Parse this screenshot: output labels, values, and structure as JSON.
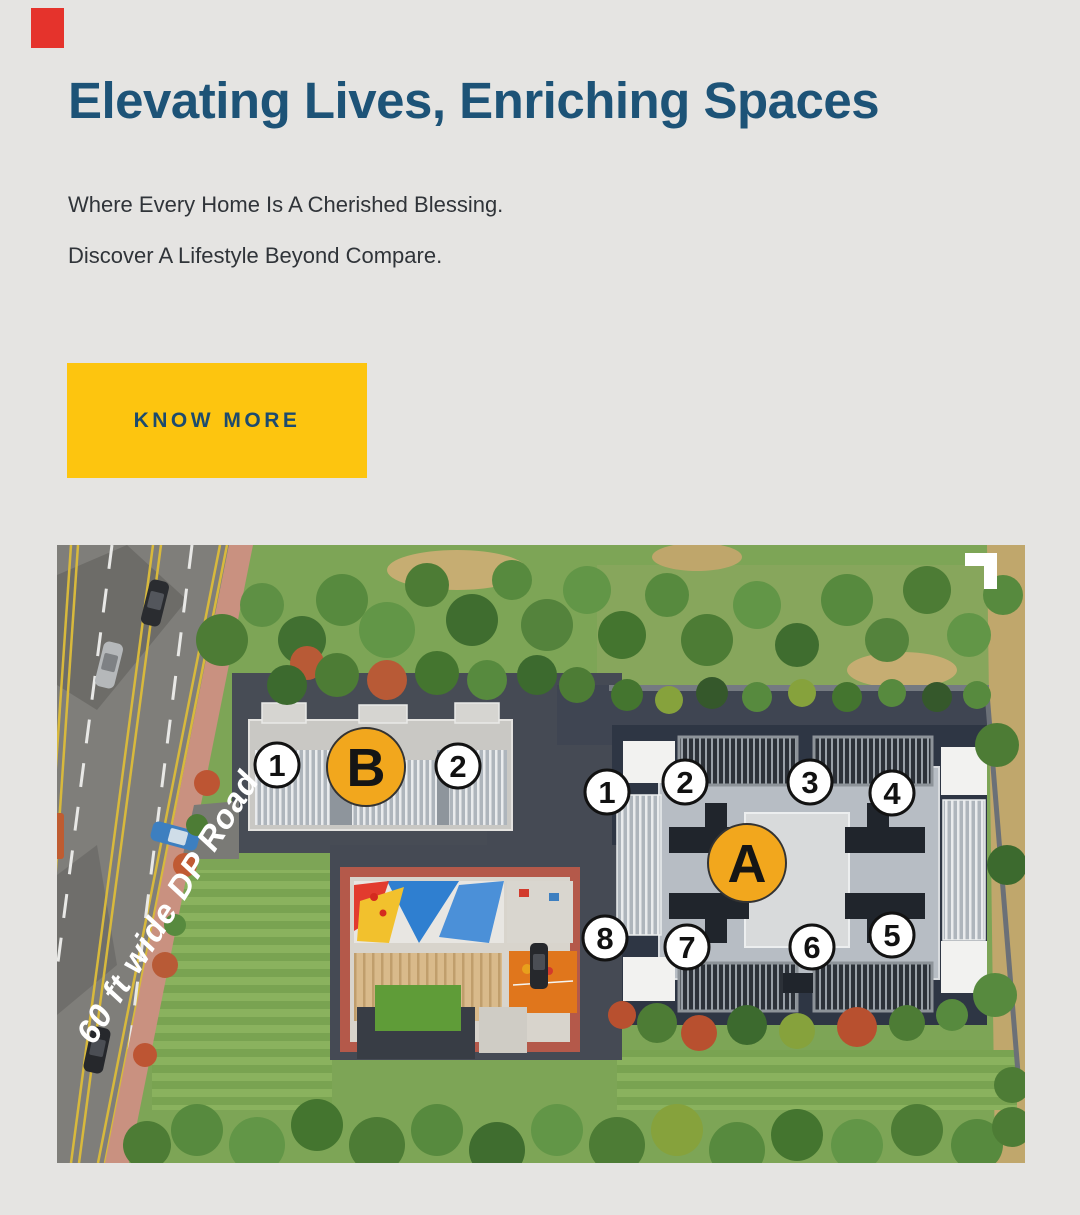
{
  "hero": {
    "accent_color": "#e5332c",
    "title": "Elevating Lives, Enriching Spaces",
    "title_color": "#1d5377",
    "subtitle_line1": "Where Every Home Is A Cherished Blessing.",
    "subtitle_line2": "Discover A Lifestyle Beyond Compare.",
    "cta_label": "KNOW MORE",
    "cta_bg": "#fdc50f",
    "cta_text_color": "#1d4b6e"
  },
  "siteplan": {
    "road_label": "60 ft wide DP Road",
    "expand_icon": "corner-bracket-icon",
    "marker_accent_color": "#f2a71d",
    "buildings": [
      {
        "id": "B",
        "unit_markers": [
          "1",
          "2"
        ]
      },
      {
        "id": "A",
        "unit_markers": [
          "1",
          "2",
          "3",
          "4",
          "5",
          "6",
          "7",
          "8"
        ]
      }
    ],
    "markers": [
      {
        "label": "1"
      },
      {
        "label": "B"
      },
      {
        "label": "2"
      },
      {
        "label": "1"
      },
      {
        "label": "2"
      },
      {
        "label": "3"
      },
      {
        "label": "4"
      },
      {
        "label": "A"
      },
      {
        "label": "8"
      },
      {
        "label": "7"
      },
      {
        "label": "6"
      },
      {
        "label": "5"
      }
    ]
  }
}
